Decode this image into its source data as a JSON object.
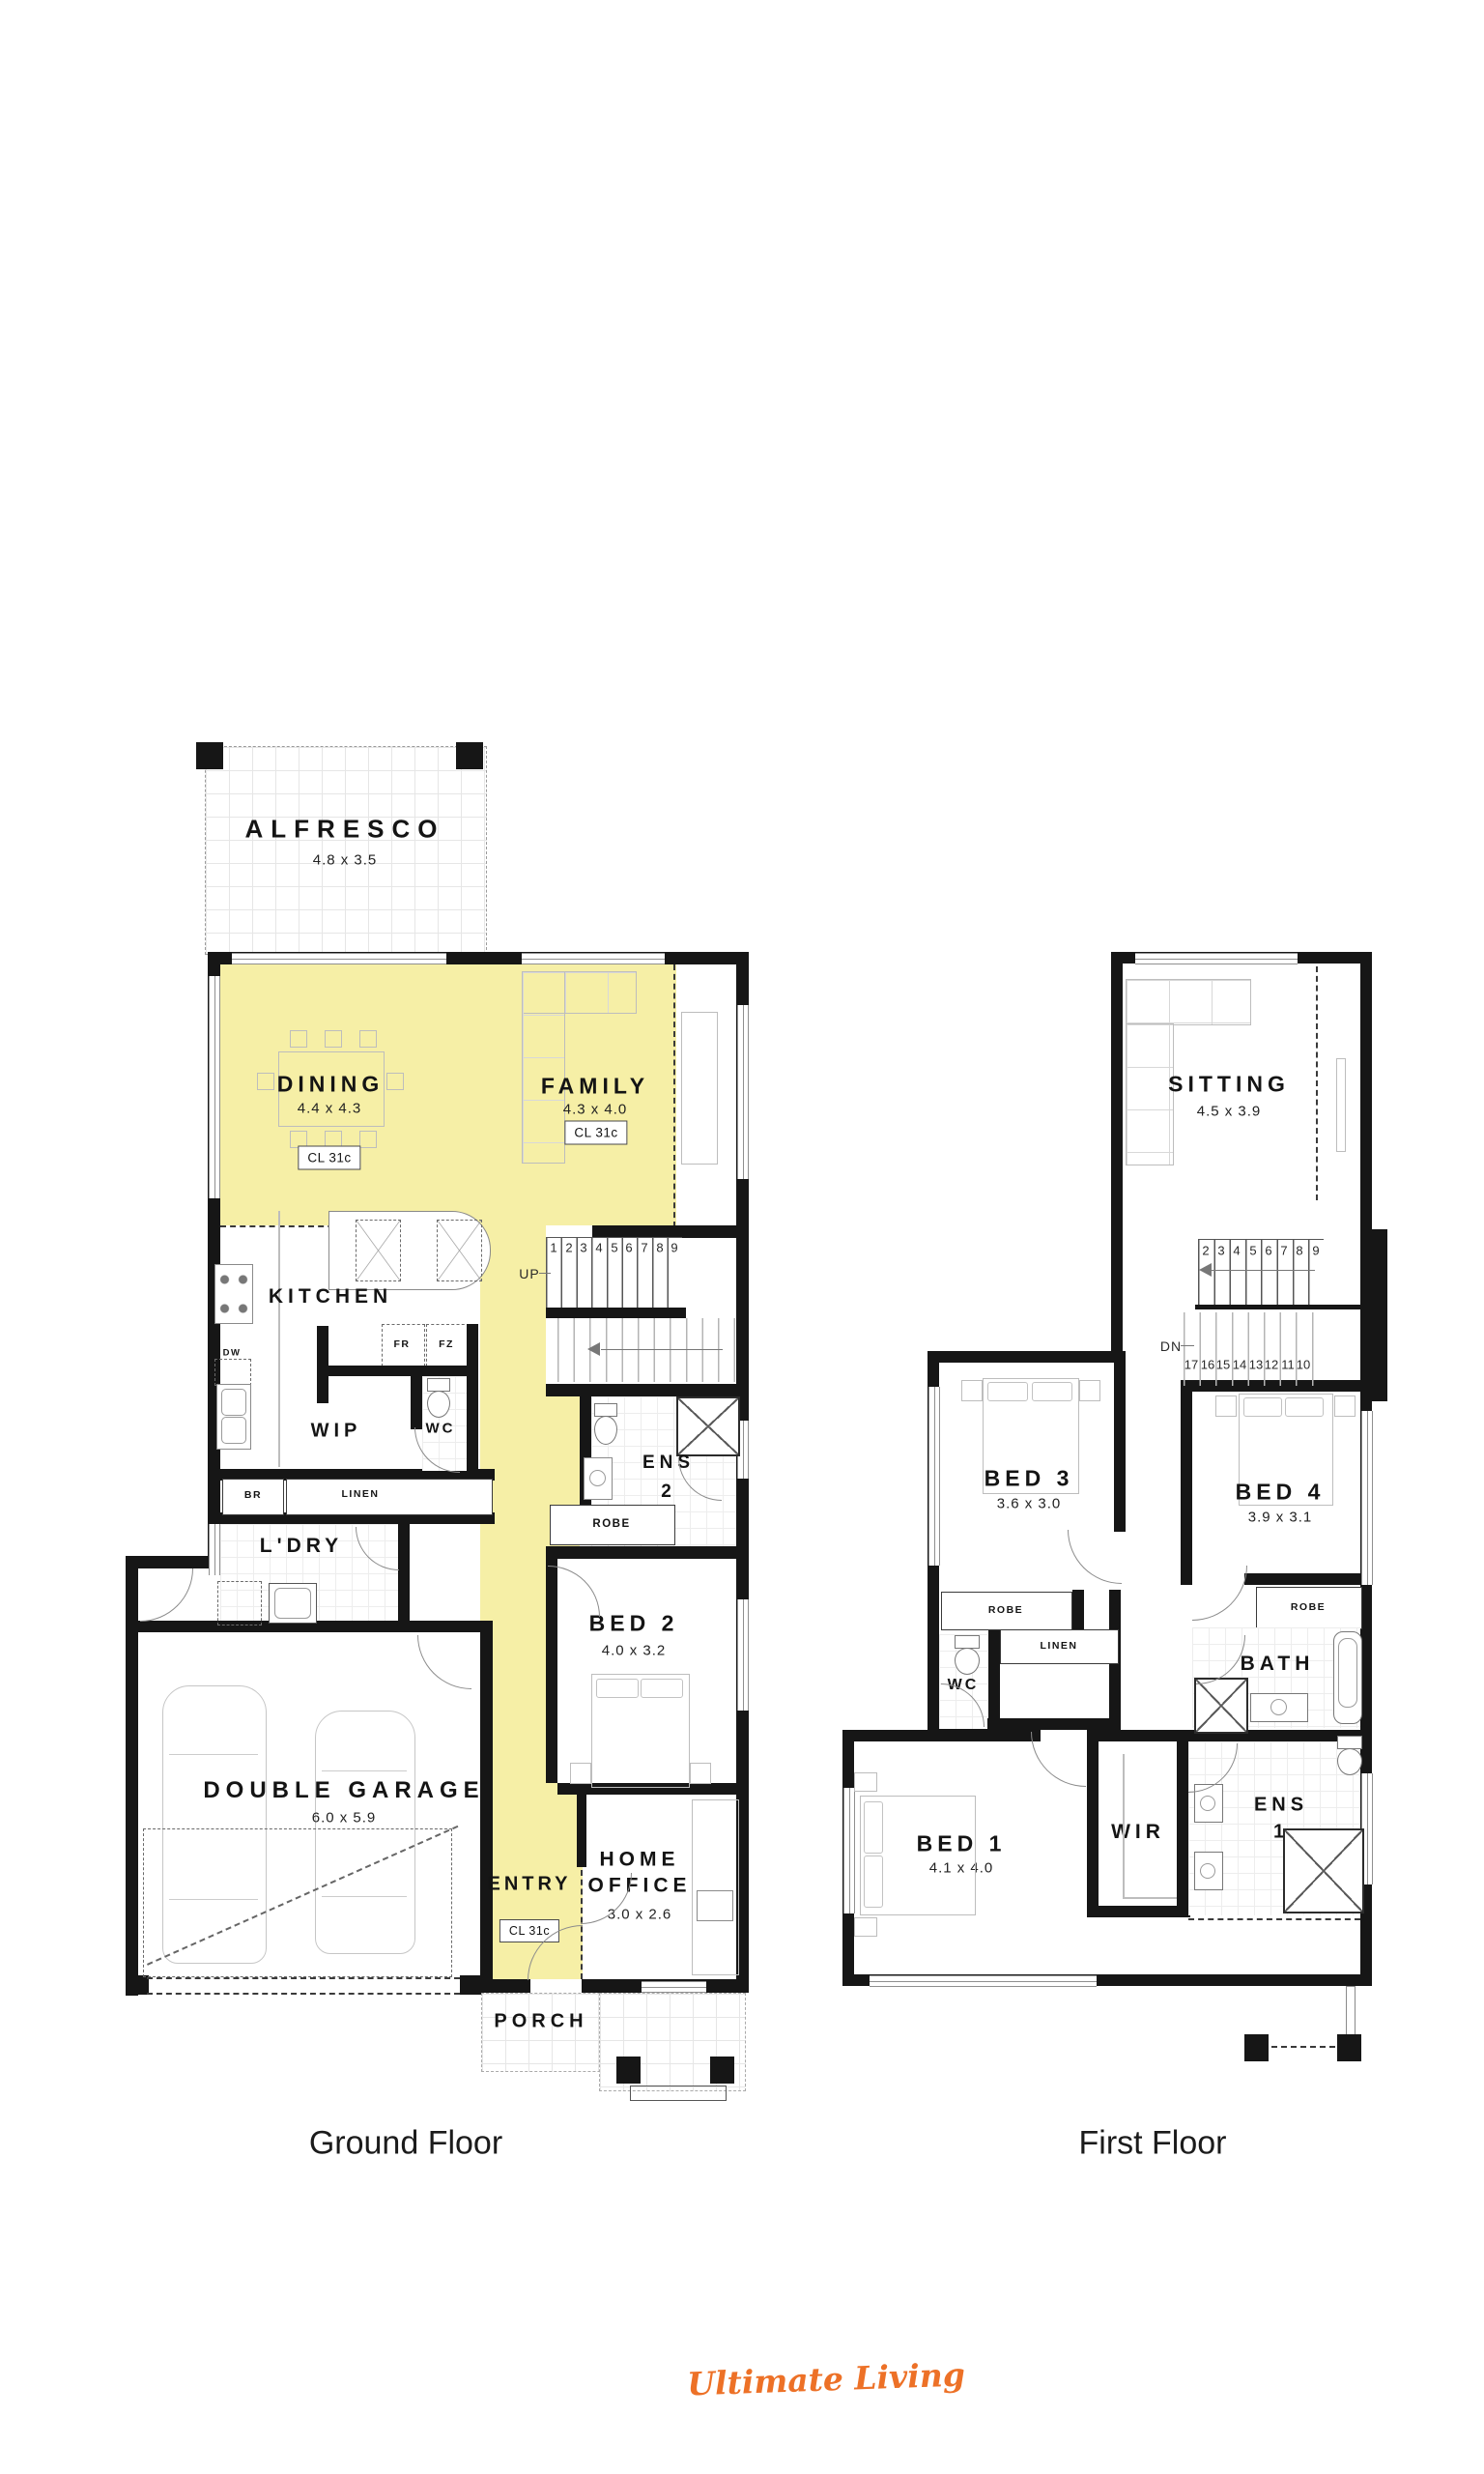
{
  "meta": {
    "ground_caption": "Ground Floor",
    "first_caption": "First Floor",
    "brand": "Ultimate Living"
  },
  "colors": {
    "highlight_yellow": "#F6EFA6",
    "brand_orange": "#ED7127",
    "wall_black": "#161616"
  },
  "ground": {
    "alfresco": {
      "name": "ALFRESCO",
      "dims": "4.8 x 3.5"
    },
    "dining": {
      "name": "DINING",
      "dims": "4.4 x 4.3",
      "ceiling": "CL 31c"
    },
    "family": {
      "name": "FAMILY",
      "dims": "4.3 x 4.0",
      "ceiling": "CL 31c"
    },
    "kitchen": {
      "name": "KITCHEN"
    },
    "fridge": "FR",
    "freezer": "FZ",
    "dishwasher": "DW",
    "wip": {
      "name": "WIP"
    },
    "wc": {
      "name": "WC"
    },
    "broom": "BR",
    "linen": "LINEN",
    "laundry": {
      "name": "L'DRY"
    },
    "stairs": {
      "up": "UP",
      "numbers": [
        "1",
        "2",
        "3",
        "4",
        "5",
        "6",
        "7",
        "8",
        "9"
      ]
    },
    "ens2": {
      "name": "ENS",
      "number": "2"
    },
    "robe": "ROBE",
    "bed2": {
      "name": "BED 2",
      "dims": "4.0 x 3.2"
    },
    "garage": {
      "name": "DOUBLE GARAGE",
      "dims": "6.0 x 5.9"
    },
    "entry": {
      "name": "ENTRY",
      "ceiling": "CL 31c"
    },
    "office": {
      "name": "HOME OFFICE",
      "dims": "3.0 x 2.6"
    },
    "porch": {
      "name": "PORCH"
    }
  },
  "first": {
    "sitting": {
      "name": "SITTING",
      "dims": "4.5 x 3.9"
    },
    "stairs": {
      "down": "DN",
      "numbers_upper": [
        "2",
        "3",
        "4",
        "5",
        "6",
        "7",
        "8",
        "9"
      ],
      "numbers_lower": [
        "17",
        "16",
        "15",
        "14",
        "13",
        "12",
        "11",
        "10"
      ]
    },
    "bed3": {
      "name": "BED 3",
      "dims": "3.6 x 3.0"
    },
    "bed4": {
      "name": "BED 4",
      "dims": "3.9 x 3.1"
    },
    "robe_bed3": "ROBE",
    "robe_bed4": "ROBE",
    "linen": "LINEN",
    "wc": {
      "name": "WC"
    },
    "bath": {
      "name": "BATH"
    },
    "bed1": {
      "name": "BED 1",
      "dims": "4.1 x 4.0"
    },
    "wir": {
      "name": "WIR"
    },
    "ens1": {
      "name": "ENS",
      "number": "1"
    }
  }
}
